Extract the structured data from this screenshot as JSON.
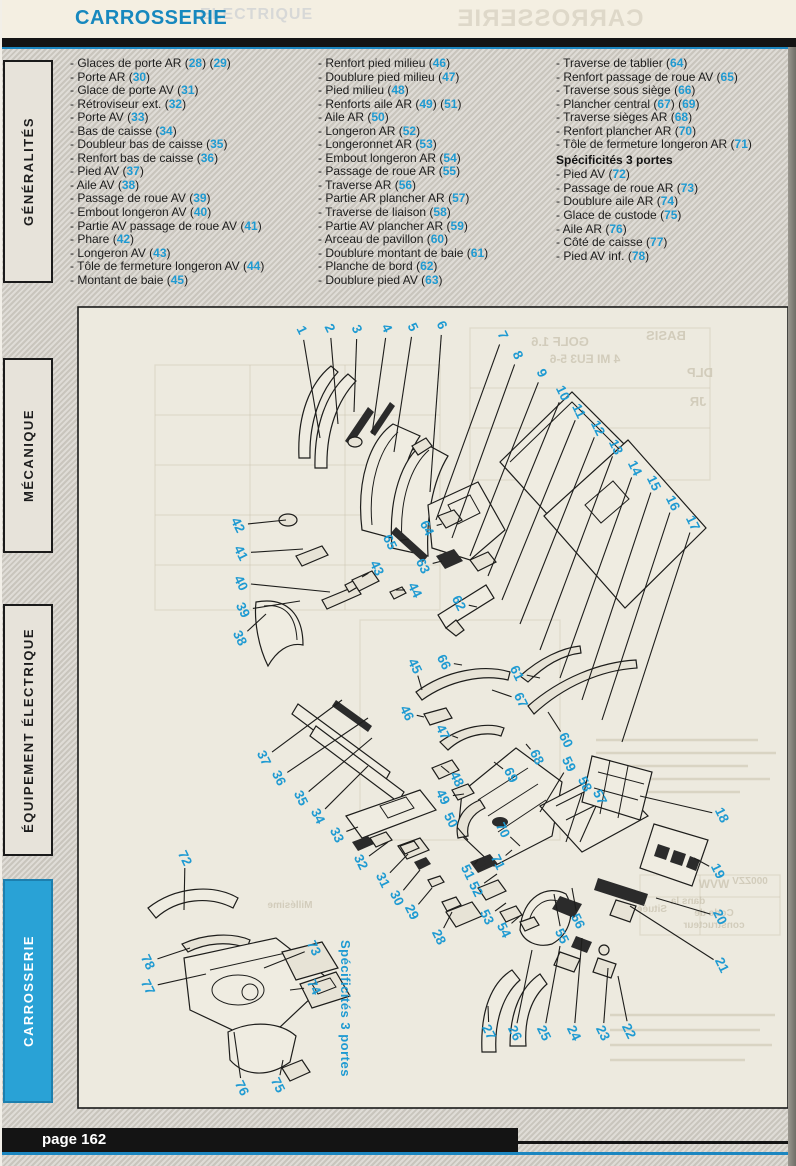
{
  "page": {
    "header_title": "CARROSSERIE",
    "page_label": "page 162"
  },
  "colors": {
    "accent_blue": "#1788be",
    "callout_blue": "#1e9ad2",
    "tab_active_bg": "#29a2d6",
    "text_dark": "#1c1c1c",
    "ghost": "#c9c3b0",
    "line_blue": "#1b86c0"
  },
  "ghost_header": {
    "mirrored_title": "CARROSSERIE",
    "offset_text": "ELECTRIQUE"
  },
  "sidebar": {
    "tabs": [
      {
        "label": "GÉNÉRALITÉS",
        "active": false
      },
      {
        "label": "MÉCANIQUE",
        "active": false
      },
      {
        "label": "ÉQUIPEMENT ÉLECTRIQUE",
        "active": false
      },
      {
        "label": "CARROSSERIE",
        "active": true
      }
    ]
  },
  "parts_list": {
    "columns": [
      {
        "items": [
          {
            "label": "Glaces de porte AR",
            "refs": [
              "28",
              "29"
            ]
          },
          {
            "label": "Porte AR",
            "refs": [
              "30"
            ]
          },
          {
            "label": "Glace de porte AV",
            "refs": [
              "31"
            ]
          },
          {
            "label": "Rétroviseur ext.",
            "refs": [
              "32"
            ]
          },
          {
            "label": "Porte AV",
            "refs": [
              "33"
            ]
          },
          {
            "label": "Bas de caisse",
            "refs": [
              "34"
            ]
          },
          {
            "label": "Doubleur bas de caisse",
            "refs": [
              "35"
            ]
          },
          {
            "label": "Renfort bas de caisse",
            "refs": [
              "36"
            ]
          },
          {
            "label": "Pied AV",
            "refs": [
              "37"
            ]
          },
          {
            "label": "Aile AV",
            "refs": [
              "38"
            ]
          },
          {
            "label": "Passage de roue AV",
            "refs": [
              "39"
            ]
          },
          {
            "label": "Embout longeron AV",
            "refs": [
              "40"
            ]
          },
          {
            "label": "Partie AV passage de roue AV",
            "refs": [
              "41"
            ]
          },
          {
            "label": "Phare",
            "refs": [
              "42"
            ]
          },
          {
            "label": "Longeron AV",
            "refs": [
              "43"
            ]
          },
          {
            "label": "Tôle de fermeture longeron AV",
            "refs": [
              "44"
            ]
          },
          {
            "label": "Montant de baie",
            "refs": [
              "45"
            ]
          }
        ]
      },
      {
        "items": [
          {
            "label": "Renfort pied milieu",
            "refs": [
              "46"
            ]
          },
          {
            "label": "Doublure pied milieu",
            "refs": [
              "47"
            ]
          },
          {
            "label": "Pied milieu",
            "refs": [
              "48"
            ]
          },
          {
            "label": "Renforts aile AR",
            "refs": [
              "49",
              "51"
            ]
          },
          {
            "label": "Aile AR",
            "refs": [
              "50"
            ]
          },
          {
            "label": "Longeron AR",
            "refs": [
              "52"
            ]
          },
          {
            "label": "Longeronnet AR",
            "refs": [
              "53"
            ]
          },
          {
            "label": "Embout longeron AR",
            "refs": [
              "54"
            ]
          },
          {
            "label": "Passage de roue AR",
            "refs": [
              "55"
            ]
          },
          {
            "label": "Traverse AR",
            "refs": [
              "56"
            ]
          },
          {
            "label": "Partie AR plancher AR",
            "refs": [
              "57"
            ]
          },
          {
            "label": "Traverse de liaison",
            "refs": [
              "58"
            ]
          },
          {
            "label": "Partie AV plancher AR",
            "refs": [
              "59"
            ]
          },
          {
            "label": "Arceau de pavillon",
            "refs": [
              "60"
            ]
          },
          {
            "label": "Doublure montant de baie",
            "refs": [
              "61"
            ]
          },
          {
            "label": "Planche de bord",
            "refs": [
              "62"
            ]
          },
          {
            "label": "Doublure pied AV",
            "refs": [
              "63"
            ]
          }
        ]
      },
      {
        "items": [
          {
            "label": "Traverse de tablier",
            "refs": [
              "64"
            ]
          },
          {
            "label": "Renfort passage de roue AV",
            "refs": [
              "65"
            ]
          },
          {
            "label": "Traverse sous siège",
            "refs": [
              "66"
            ]
          },
          {
            "label": "Plancher central",
            "refs": [
              "67",
              "69"
            ]
          },
          {
            "label": "Traverse sièges AR",
            "refs": [
              "68"
            ]
          },
          {
            "label": "Renfort plancher AR",
            "refs": [
              "70"
            ]
          },
          {
            "label": "Tôle de fermeture longeron AR",
            "refs": [
              "71"
            ]
          },
          {
            "header": "Spécificités 3 portes"
          },
          {
            "label": "Pied AV",
            "refs": [
              "72"
            ]
          },
          {
            "label": "Passage de roue AR",
            "refs": [
              "73"
            ]
          },
          {
            "label": "Doublure aile AR",
            "refs": [
              "74"
            ]
          },
          {
            "label": "Glace de custode",
            "refs": [
              "75"
            ]
          },
          {
            "label": "Aile AR",
            "refs": [
              "76"
            ]
          },
          {
            "label": "Côté de caisse",
            "refs": [
              "77"
            ]
          },
          {
            "label": "Pied AV inf.",
            "refs": [
              "78"
            ]
          }
        ]
      }
    ]
  },
  "diagram": {
    "note": "Spécificités 3 portes",
    "callouts": [
      {
        "n": "1",
        "x": 302,
        "y": 330,
        "tx": 320,
        "ty": 438
      },
      {
        "n": "2",
        "x": 330,
        "y": 328,
        "tx": 338,
        "ty": 424
      },
      {
        "n": "3",
        "x": 357,
        "y": 329,
        "tx": 354,
        "ty": 412
      },
      {
        "n": "4",
        "x": 387,
        "y": 328,
        "tx": 372,
        "ty": 434
      },
      {
        "n": "5",
        "x": 413,
        "y": 327,
        "tx": 394,
        "ty": 452
      },
      {
        "n": "6",
        "x": 442,
        "y": 325,
        "tx": 430,
        "ty": 492
      },
      {
        "n": "7",
        "x": 503,
        "y": 335,
        "tx": 436,
        "ty": 520
      },
      {
        "n": "8",
        "x": 518,
        "y": 355,
        "tx": 452,
        "ty": 538
      },
      {
        "n": "9",
        "x": 542,
        "y": 373,
        "tx": 470,
        "ty": 556
      },
      {
        "n": "10",
        "x": 563,
        "y": 393,
        "tx": 488,
        "ty": 576
      },
      {
        "n": "11",
        "x": 579,
        "y": 411,
        "tx": 502,
        "ty": 600
      },
      {
        "n": "12",
        "x": 598,
        "y": 428,
        "tx": 520,
        "ty": 624
      },
      {
        "n": "13",
        "x": 616,
        "y": 447,
        "tx": 540,
        "ty": 650
      },
      {
        "n": "14",
        "x": 635,
        "y": 468,
        "tx": 560,
        "ty": 678
      },
      {
        "n": "15",
        "x": 654,
        "y": 483,
        "tx": 582,
        "ty": 700
      },
      {
        "n": "16",
        "x": 673,
        "y": 503,
        "tx": 602,
        "ty": 720
      },
      {
        "n": "17",
        "x": 693,
        "y": 523,
        "tx": 622,
        "ty": 742
      },
      {
        "n": "18",
        "x": 722,
        "y": 815,
        "tx": 640,
        "ty": 796
      },
      {
        "n": "19",
        "x": 718,
        "y": 871,
        "tx": 694,
        "ty": 858
      },
      {
        "n": "20",
        "x": 720,
        "y": 917,
        "tx": 656,
        "ty": 898
      },
      {
        "n": "21",
        "x": 722,
        "y": 965,
        "tx": 630,
        "ty": 906
      },
      {
        "n": "22",
        "x": 629,
        "y": 1031,
        "tx": 618,
        "ty": 976
      },
      {
        "n": "23",
        "x": 603,
        "y": 1033,
        "tx": 608,
        "ty": 968
      },
      {
        "n": "24",
        "x": 574,
        "y": 1033,
        "tx": 582,
        "ty": 938
      },
      {
        "n": "25",
        "x": 544,
        "y": 1033,
        "tx": 560,
        "ty": 946
      },
      {
        "n": "26",
        "x": 515,
        "y": 1033,
        "tx": 532,
        "ty": 950
      },
      {
        "n": "27",
        "x": 489,
        "y": 1032,
        "tx": 488,
        "ty": 1006
      },
      {
        "n": "28",
        "x": 439,
        "y": 937,
        "tx": 452,
        "ty": 912
      },
      {
        "n": "29",
        "x": 412,
        "y": 912,
        "tx": 432,
        "ty": 888
      },
      {
        "n": "30",
        "x": 397,
        "y": 898,
        "tx": 420,
        "ty": 870
      },
      {
        "n": "31",
        "x": 383,
        "y": 880,
        "tx": 408,
        "ty": 854
      },
      {
        "n": "32",
        "x": 361,
        "y": 862,
        "tx": 388,
        "ty": 842
      },
      {
        "n": "33",
        "x": 337,
        "y": 835,
        "tx": 358,
        "ty": 827
      },
      {
        "n": "34",
        "x": 318,
        "y": 816,
        "tx": 368,
        "ty": 766
      },
      {
        "n": "35",
        "x": 301,
        "y": 798,
        "tx": 372,
        "ty": 738
      },
      {
        "n": "36",
        "x": 279,
        "y": 778,
        "tx": 368,
        "ty": 718
      },
      {
        "n": "37",
        "x": 264,
        "y": 758,
        "tx": 342,
        "ty": 700
      },
      {
        "n": "38",
        "x": 240,
        "y": 638,
        "tx": 266,
        "ty": 614
      },
      {
        "n": "39",
        "x": 243,
        "y": 610,
        "tx": 300,
        "ty": 601
      },
      {
        "n": "40",
        "x": 241,
        "y": 583,
        "tx": 330,
        "ty": 592
      },
      {
        "n": "41",
        "x": 241,
        "y": 553,
        "tx": 303,
        "ty": 549
      },
      {
        "n": "42",
        "x": 238,
        "y": 525,
        "tx": 286,
        "ty": 520
      },
      {
        "n": "43",
        "x": 377,
        "y": 568,
        "tx": 362,
        "ty": 577
      },
      {
        "n": "44",
        "x": 415,
        "y": 590,
        "tx": 396,
        "ty": 590
      },
      {
        "n": "45",
        "x": 415,
        "y": 666,
        "tx": 422,
        "ty": 690
      },
      {
        "n": "46",
        "x": 407,
        "y": 713,
        "tx": 424,
        "ty": 717
      },
      {
        "n": "47",
        "x": 443,
        "y": 732,
        "tx": 458,
        "ty": 738
      },
      {
        "n": "48",
        "x": 457,
        "y": 779,
        "tx": 441,
        "ty": 766
      },
      {
        "n": "49",
        "x": 443,
        "y": 797,
        "tx": 464,
        "ty": 794
      },
      {
        "n": "50",
        "x": 451,
        "y": 820,
        "tx": 468,
        "ty": 840
      },
      {
        "n": "51",
        "x": 468,
        "y": 872,
        "tx": 478,
        "ty": 860
      },
      {
        "n": "52",
        "x": 476,
        "y": 889,
        "tx": 497,
        "ty": 874
      },
      {
        "n": "53",
        "x": 487,
        "y": 917,
        "tx": 506,
        "ty": 903
      },
      {
        "n": "54",
        "x": 504,
        "y": 930,
        "tx": 521,
        "ty": 915
      },
      {
        "n": "55",
        "x": 562,
        "y": 936,
        "tx": 554,
        "ty": 894
      },
      {
        "n": "56",
        "x": 578,
        "y": 921,
        "tx": 572,
        "ty": 888
      },
      {
        "n": "57",
        "x": 600,
        "y": 797,
        "tx": 580,
        "ty": 842
      },
      {
        "n": "58",
        "x": 585,
        "y": 784,
        "tx": 566,
        "ty": 842
      },
      {
        "n": "59",
        "x": 569,
        "y": 764,
        "tx": 540,
        "ty": 812
      },
      {
        "n": "60",
        "x": 566,
        "y": 740,
        "tx": 548,
        "ty": 712
      },
      {
        "n": "61",
        "x": 517,
        "y": 673,
        "tx": 540,
        "ty": 678
      },
      {
        "n": "62",
        "x": 459,
        "y": 603,
        "tx": 477,
        "ty": 607
      },
      {
        "n": "63",
        "x": 423,
        "y": 566,
        "tx": 442,
        "ty": 561
      },
      {
        "n": "64",
        "x": 427,
        "y": 528,
        "tx": 442,
        "ty": 524
      },
      {
        "n": "65",
        "x": 390,
        "y": 542,
        "tx": 409,
        "ty": 539
      },
      {
        "n": "66",
        "x": 444,
        "y": 662,
        "tx": 462,
        "ty": 665
      },
      {
        "n": "67",
        "x": 521,
        "y": 700,
        "tx": 492,
        "ty": 690
      },
      {
        "n": "68",
        "x": 537,
        "y": 757,
        "tx": 526,
        "ty": 744
      },
      {
        "n": "69",
        "x": 511,
        "y": 775,
        "tx": 494,
        "ty": 762
      },
      {
        "n": "70",
        "x": 503,
        "y": 830,
        "tx": 520,
        "ty": 846
      },
      {
        "n": "71",
        "x": 498,
        "y": 862,
        "tx": 512,
        "ty": 850
      },
      {
        "n": "72",
        "x": 185,
        "y": 858,
        "tx": 184,
        "ty": 910
      },
      {
        "n": "73",
        "x": 314,
        "y": 948,
        "tx": 264,
        "ty": 968
      },
      {
        "n": "74",
        "x": 314,
        "y": 987,
        "tx": 290,
        "ty": 990
      },
      {
        "n": "75",
        "x": 278,
        "y": 1085,
        "tx": 283,
        "ty": 1060
      },
      {
        "n": "76",
        "x": 242,
        "y": 1088,
        "tx": 234,
        "ty": 1032
      },
      {
        "n": "77",
        "x": 148,
        "y": 987,
        "tx": 206,
        "ty": 974
      },
      {
        "n": "78",
        "x": 148,
        "y": 962,
        "tx": 190,
        "ty": 948
      }
    ],
    "ghost_texts": [
      {
        "t": "GOLF 1.6",
        "x": 560,
        "y": 346,
        "s": 13
      },
      {
        "t": "BASIS",
        "x": 666,
        "y": 340,
        "s": 13
      },
      {
        "t": "4 MI EU3 5-6",
        "x": 585,
        "y": 363,
        "s": 12
      },
      {
        "t": "DLP",
        "x": 700,
        "y": 377,
        "s": 13
      },
      {
        "t": "JR",
        "x": 698,
        "y": 406,
        "s": 13
      },
      {
        "t": "WVW",
        "x": 714,
        "y": 888,
        "s": 12
      },
      {
        "t": "000ZZV",
        "x": 750,
        "y": 884,
        "s": 10
      },
      {
        "t": "Code de",
        "x": 714,
        "y": 916,
        "s": 10
      },
      {
        "t": "constructeur",
        "x": 714,
        "y": 928,
        "s": 10
      },
      {
        "t": "Située",
        "x": 652,
        "y": 912,
        "s": 10
      },
      {
        "t": "dans la",
        "x": 688,
        "y": 904,
        "s": 10
      },
      {
        "t": "Millésime",
        "x": 290,
        "y": 908,
        "s": 10
      }
    ]
  }
}
